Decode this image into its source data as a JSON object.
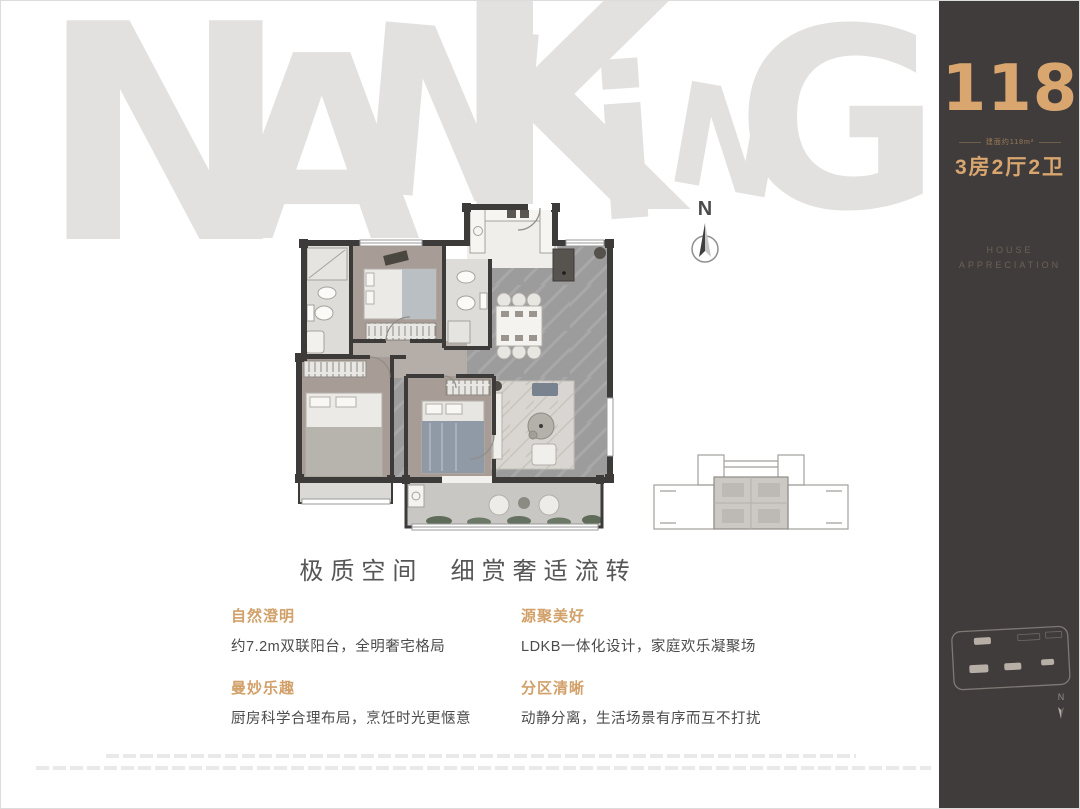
{
  "watermark": {
    "text": "NANKING",
    "color": "#e2e1df",
    "letters": [
      {
        "ch": "N",
        "x": 38,
        "y": -15,
        "s": 300,
        "r": 0
      },
      {
        "ch": "A",
        "x": 222,
        "y": 22,
        "s": 255,
        "r": 0
      },
      {
        "ch": "N",
        "x": 355,
        "y": 0,
        "s": 235,
        "r": 5
      },
      {
        "ch": "K",
        "x": 448,
        "y": -45,
        "s": 300,
        "r": 0
      },
      {
        "ch": "i",
        "x": 588,
        "y": 40,
        "s": 210,
        "r": -4
      },
      {
        "ch": "N",
        "x": 668,
        "y": 72,
        "s": 140,
        "r": 10
      },
      {
        "ch": "G",
        "x": 735,
        "y": -5,
        "s": 250,
        "r": 0
      }
    ]
  },
  "plan": {
    "north_label": "N"
  },
  "headline": "极质空间  细赏奢适流转",
  "features": [
    {
      "title": "自然澄明",
      "desc": "约7.2m双联阳台，全明奢宅格局"
    },
    {
      "title": "源聚美好",
      "desc": "LDKB一体化设计，家庭欢乐凝聚场"
    },
    {
      "title": "曼妙乐趣",
      "desc": "厨房科学合理布局，烹饪时光更惬意"
    },
    {
      "title": "分区清晰",
      "desc": "动静分离，生活场景有序而互不打扰"
    }
  ],
  "sidebar": {
    "area_number": "118",
    "area_note": "建面约118m²",
    "layout": "3房2厅2卫",
    "tagline_line1": "HOUSE",
    "tagline_line2": "APPRECIATION",
    "mini_north_label": "N",
    "colors": {
      "background": "#403c3c",
      "gold": "#d8a66e",
      "tagline": "#6b6156"
    }
  }
}
